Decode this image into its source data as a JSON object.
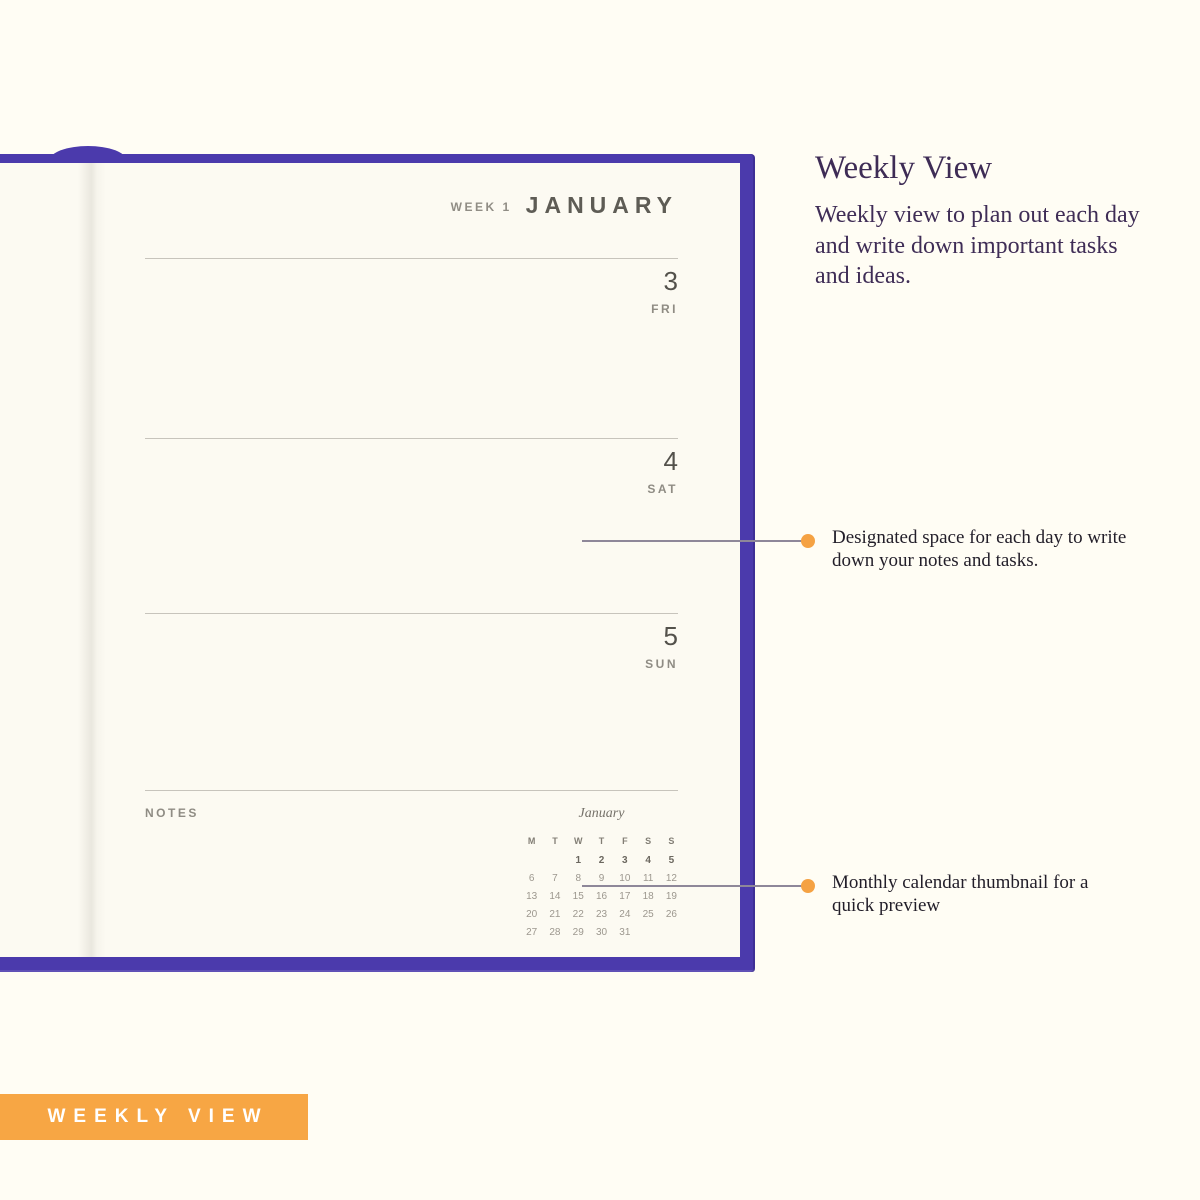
{
  "colors": {
    "background": "#FFFDF4",
    "cover_purple": "#4B3AAC",
    "accent_orange": "#F7A644",
    "connector_gray": "#8E8799"
  },
  "planner": {
    "header": {
      "week_label": "WEEK 1",
      "month_title": "JANUARY"
    },
    "days": [
      {
        "date": "3",
        "weekday": "FRI"
      },
      {
        "date": "4",
        "weekday": "SAT"
      },
      {
        "date": "5",
        "weekday": "SUN"
      }
    ],
    "notes_label": "NOTES",
    "mini_calendar": {
      "title": "January",
      "weekdays": [
        "M",
        "T",
        "W",
        "T",
        "F",
        "S",
        "S"
      ],
      "weeks": [
        [
          "",
          "",
          "1",
          "2",
          "3",
          "4",
          "5"
        ],
        [
          "6",
          "7",
          "8",
          "9",
          "10",
          "11",
          "12"
        ],
        [
          "13",
          "14",
          "15",
          "16",
          "17",
          "18",
          "19"
        ],
        [
          "20",
          "21",
          "22",
          "23",
          "24",
          "25",
          "26"
        ],
        [
          "27",
          "28",
          "29",
          "30",
          "31",
          "",
          ""
        ]
      ]
    }
  },
  "feature": {
    "title": "Weekly View",
    "description": "Weekly view to plan out each day and write down important tasks and ideas."
  },
  "callouts": [
    {
      "text": "Designated space for each day to write down your notes and tasks."
    },
    {
      "text": "Monthly calendar thumbnail for a quick preview"
    }
  ],
  "banner": {
    "label": "WEEKLY VIEW"
  }
}
